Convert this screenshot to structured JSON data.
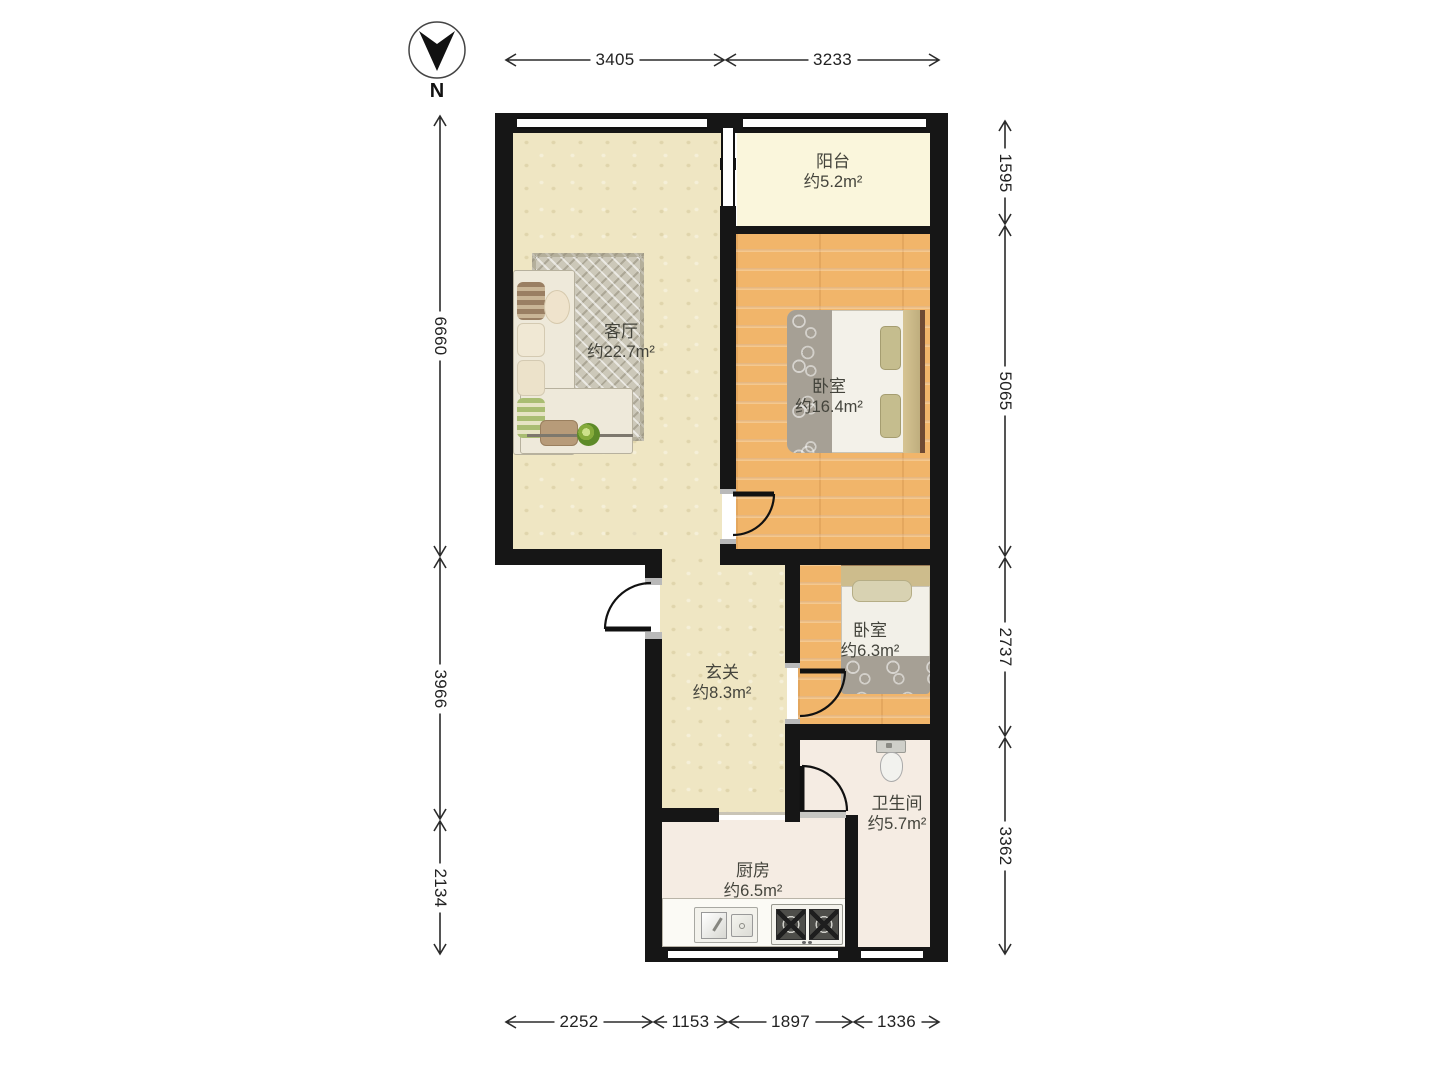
{
  "compass": {
    "label": "N"
  },
  "rooms": [
    {
      "id": "balcony",
      "name": "阳台",
      "area": "约5.2m²"
    },
    {
      "id": "living-room",
      "name": "客厅",
      "area": "约22.7m²"
    },
    {
      "id": "master-bedroom",
      "name": "卧室",
      "area": "约16.4m²"
    },
    {
      "id": "second-bedroom",
      "name": "卧室",
      "area": "约6.3m²"
    },
    {
      "id": "hallway",
      "name": "玄关",
      "area": "约8.3m²"
    },
    {
      "id": "bathroom",
      "name": "卫生间",
      "area": "约5.7m²"
    },
    {
      "id": "kitchen",
      "name": "厨房",
      "area": "约6.5m²"
    }
  ],
  "dim_segments": [
    {
      "label": "3405",
      "orient": "h",
      "y": 60,
      "from": 505,
      "to": 725
    },
    {
      "label": "3233",
      "orient": "h",
      "y": 60,
      "from": 725,
      "to": 940
    },
    {
      "label": "6660",
      "orient": "v",
      "x": 440,
      "from": 115,
      "to": 557
    },
    {
      "label": "3966",
      "orient": "v",
      "x": 440,
      "from": 557,
      "to": 820
    },
    {
      "label": "2134",
      "orient": "v",
      "x": 440,
      "from": 820,
      "to": 955
    },
    {
      "label": "1595",
      "orient": "v",
      "x": 1005,
      "from": 120,
      "to": 225
    },
    {
      "label": "5065",
      "orient": "v",
      "x": 1005,
      "from": 225,
      "to": 557
    },
    {
      "label": "2737",
      "orient": "v",
      "x": 1005,
      "from": 557,
      "to": 737
    },
    {
      "label": "3362",
      "orient": "v",
      "x": 1005,
      "from": 737,
      "to": 955
    },
    {
      "label": "2252",
      "orient": "h",
      "y": 1022,
      "from": 505,
      "to": 653
    },
    {
      "label": "1153",
      "orient": "h",
      "y": 1022,
      "from": 653,
      "to": 728
    },
    {
      "label": "1897",
      "orient": "h",
      "y": 1022,
      "from": 728,
      "to": 853
    },
    {
      "label": "1336",
      "orient": "h",
      "y": 1022,
      "from": 853,
      "to": 940
    }
  ],
  "colors": {
    "wall": "#161616",
    "beige_floor": "#efe6c3",
    "wood_floor": "#f1b56a",
    "balcony_floor": "#faf6dc",
    "tile_floor": "#f5ece3",
    "dimension_text": "#222222"
  }
}
